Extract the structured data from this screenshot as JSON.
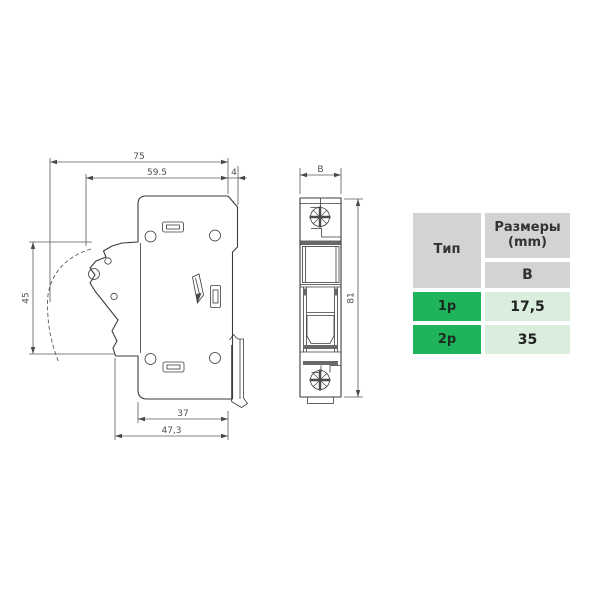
{
  "page": {
    "background": "#ffffff"
  },
  "drawing": {
    "side_view": {
      "dims": {
        "total_width": "75",
        "body_width": "59.5",
        "tab_depth": "4",
        "lever_height": "45",
        "base_inner_width": "37",
        "base_outer_width": "47,3"
      }
    },
    "front_view": {
      "dims": {
        "width": "B",
        "height": "81"
      }
    }
  },
  "table": {
    "headers": {
      "type": "Тип",
      "size_line1": "Размеры",
      "size_line2": "(mm)",
      "size_sub": "B"
    },
    "rows": [
      {
        "type": "1p",
        "b": "17,5"
      },
      {
        "type": "2p",
        "b": "35"
      }
    ],
    "colors": {
      "header_bg": "#d2d3d5",
      "type_cell_bg": "#1fb45c",
      "value_cell_bg": "#d9eedd",
      "line_color": "#3c3c3c"
    }
  }
}
